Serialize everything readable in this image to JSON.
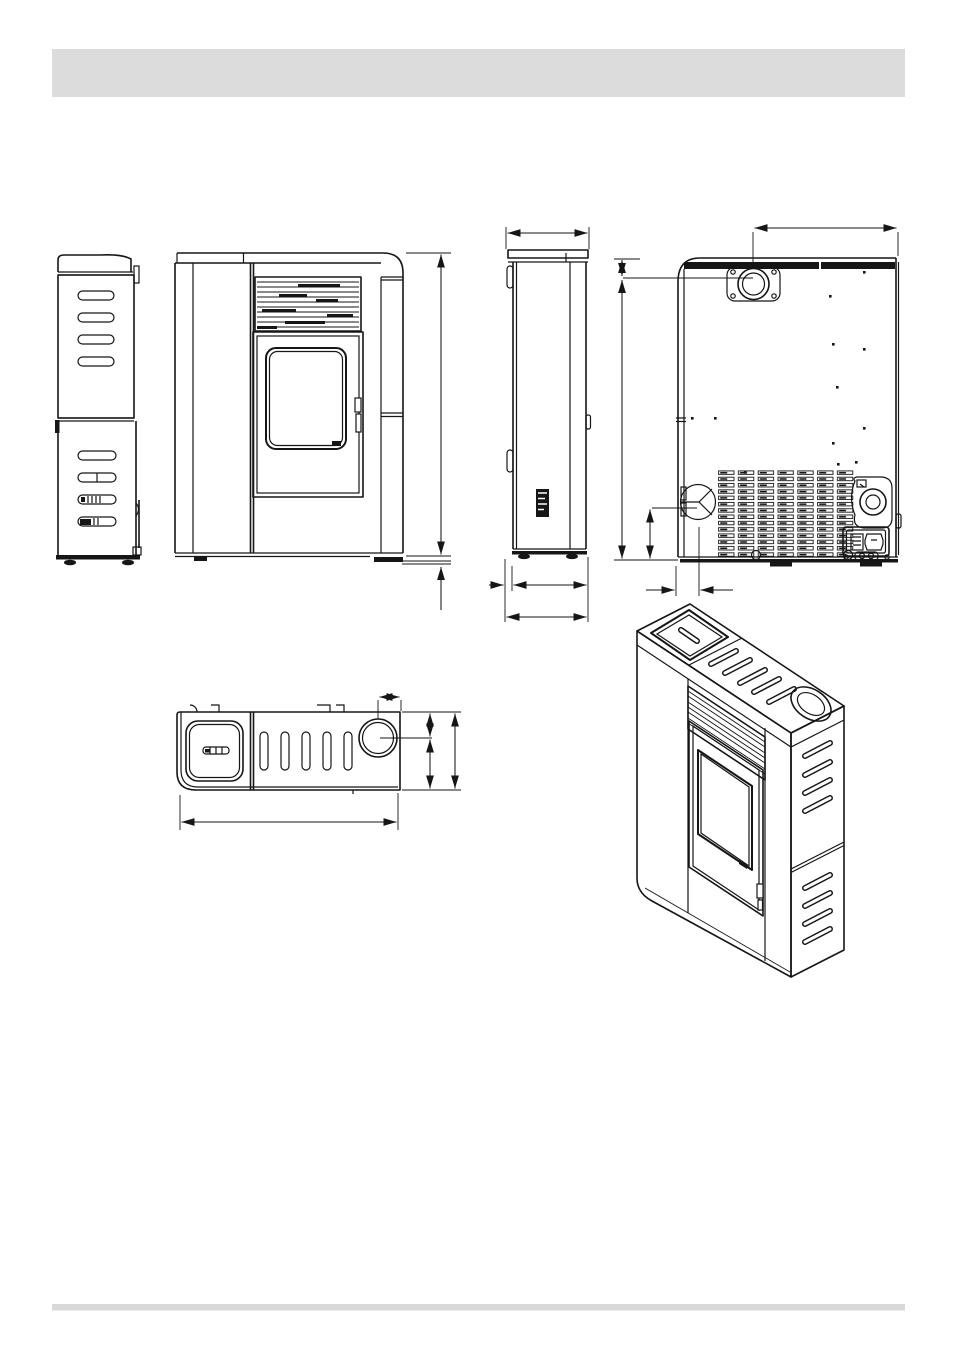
{
  "page": {
    "background": "#ffffff",
    "ink": "#161616",
    "header_bar": {
      "color": "#dcdcdc"
    },
    "footer_bar": {
      "color": "#d9d9d9"
    }
  },
  "figure": {
    "kind": "technical-dimension-drawing",
    "subject": "pellet-stove",
    "text_labels_visible": false,
    "dimension_values_visible": false,
    "views": [
      {
        "id": "left-side-view",
        "features": [
          "rounded-top",
          "upper-vent-slots",
          "lower-vent-slots",
          "feet"
        ]
      },
      {
        "id": "front-view",
        "features": [
          "top-grille",
          "glass-door",
          "door-handle",
          "base-feet",
          "height-dimension-line"
        ]
      },
      {
        "id": "side-profile-view",
        "features": [
          "top-width-dimension",
          "rating-label",
          "depth-dimension-lines",
          "feet"
        ]
      },
      {
        "id": "rear-view",
        "features": [
          "flue-outlet",
          "top-offset-dimension",
          "height-dimension-lines",
          "combustion-air-inlet",
          "air-inlet-dimensions",
          "vent-grid",
          "exhaust-fan",
          "power-socket-switch",
          "screws",
          "feet"
        ]
      },
      {
        "id": "top-view",
        "features": [
          "hopper-lid",
          "lid-handle",
          "top-slots",
          "flue-collar",
          "flue-offset-dimension",
          "depth-dimension-lines",
          "width-dimension-line"
        ]
      },
      {
        "id": "isometric-view",
        "features": [
          "hopper-lid",
          "top-slots",
          "flue-collar",
          "front-grille",
          "glass-door",
          "door-handle",
          "side-vent-slots"
        ]
      }
    ]
  }
}
